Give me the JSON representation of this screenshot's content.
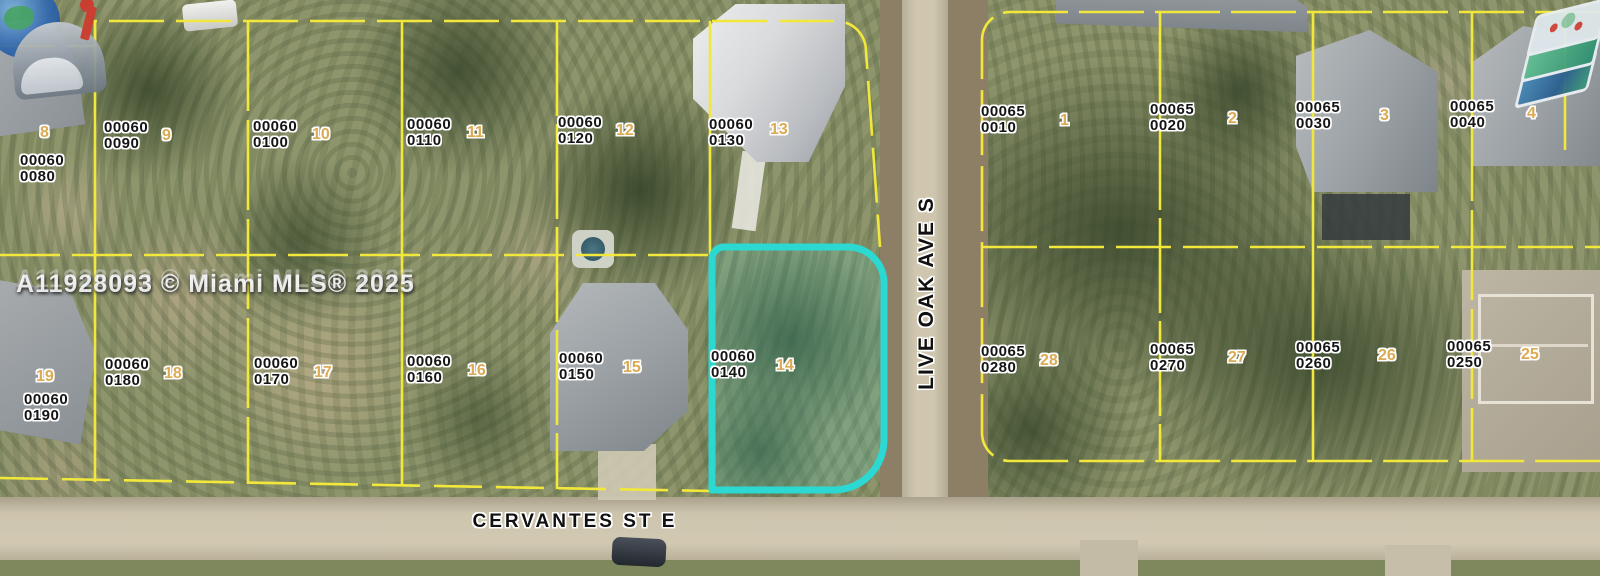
{
  "watermark": {
    "text": "A11928093 © Miami MLS® 2025"
  },
  "streets": {
    "cervantes": "CERVANTES ST E",
    "live_oak": "LIVE OAK AVE S"
  },
  "colors": {
    "parcel_line": "#f2e83c",
    "highlight_outline": "#2cd9d2",
    "lot_number": "#dcaa52",
    "label_text": "#141414"
  },
  "logos": {
    "top_left": "mailbox-globe-logo",
    "top_right": "map-layers-logo"
  },
  "highlighted_parcel": {
    "line1": "00060",
    "line2": "0140",
    "lot": "14"
  },
  "parcels": [
    {
      "line1": "00060",
      "line2": "0080",
      "lot": "8"
    },
    {
      "line1": "00060",
      "line2": "0090",
      "lot": "9"
    },
    {
      "line1": "00060",
      "line2": "0100",
      "lot": "10"
    },
    {
      "line1": "00060",
      "line2": "0110",
      "lot": "11"
    },
    {
      "line1": "00060",
      "line2": "0120",
      "lot": "12"
    },
    {
      "line1": "00060",
      "line2": "0130",
      "lot": "13"
    },
    {
      "line1": "00060",
      "line2": "0140",
      "lot": "14"
    },
    {
      "line1": "00060",
      "line2": "0150",
      "lot": "15"
    },
    {
      "line1": "00060",
      "line2": "0160",
      "lot": "16"
    },
    {
      "line1": "00060",
      "line2": "0170",
      "lot": "17"
    },
    {
      "line1": "00060",
      "line2": "0180",
      "lot": "18"
    },
    {
      "line1": "00060",
      "line2": "0190",
      "lot": "19"
    },
    {
      "line1": "00065",
      "line2": "0010",
      "lot": "1"
    },
    {
      "line1": "00065",
      "line2": "0020",
      "lot": "2"
    },
    {
      "line1": "00065",
      "line2": "0030",
      "lot": "3"
    },
    {
      "line1": "00065",
      "line2": "0040",
      "lot": "4"
    },
    {
      "line1": "00065",
      "line2": "0250",
      "lot": "25"
    },
    {
      "line1": "00065",
      "line2": "0260",
      "lot": "26"
    },
    {
      "line1": "00065",
      "line2": "0270",
      "lot": "27"
    },
    {
      "line1": "00065",
      "line2": "0280",
      "lot": "28"
    }
  ]
}
